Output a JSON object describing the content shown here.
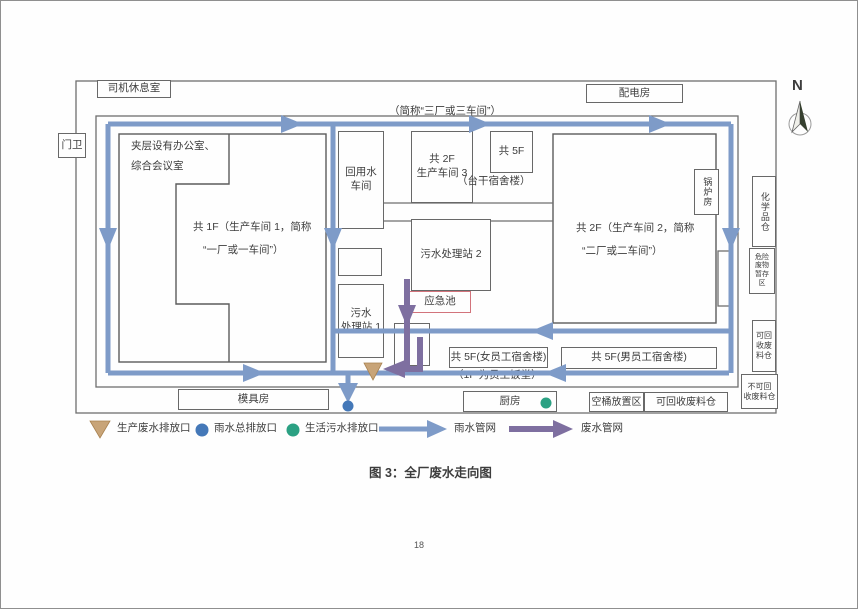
{
  "page": {
    "caption": "图 3：全厂废水走向图",
    "number": "18"
  },
  "compass": {
    "label": "N"
  },
  "colors": {
    "rain_pipe": "#7e9bc8",
    "waste_pipe": "#7e6fa0",
    "prod_marker": "#c8a478",
    "prod_marker_edge": "#a8814f",
    "rain_dot": "#4478b8",
    "domestic_dot": "#2ba183",
    "emergency": "#d2737b"
  },
  "rooms": {
    "driver_rest": "司机休息室",
    "power_dist": "配电房",
    "gate": "门卫",
    "mezzanine_l1": "夹层设有办公室、",
    "mezzanine_l2": "综合会议室",
    "workshop1_l1": "共 1F（生产车间 1，简称",
    "workshop1_l2": "“一厂或一车间”）",
    "alias3": "（简称“三厂或三车间”）",
    "reuse_l1": "回用水",
    "reuse_l2": "车间",
    "workshop3_l1": "共 2F",
    "workshop3_l2": "生产车间 3",
    "taigan_floors": "共 5F",
    "taigan_name": "（台干宿舍楼）",
    "sewage2": "污水处理站 2",
    "emergency": "应急池",
    "sewage1_l1": "污水",
    "sewage1_l2": "处理站 1",
    "workshop2_l1": "共 2F（生产车间 2，简称",
    "workshop2_l2": "“二厂或二车间”）",
    "boiler": "锅炉房",
    "chemical": "化学品仓",
    "hazard": "危险废物暂存区",
    "recycle_right": "可回收废料仓",
    "nonrecycle_l1": "不可回",
    "nonrecycle_l2": "收废料仓",
    "dorm_female": "共 5F(女员工宿舍楼)",
    "dorm_female_note": "（1F 为员工饭堂）",
    "dorm_male": "共 5F(男员工宿舍楼)",
    "mold": "模具房",
    "kitchen": "厨房",
    "bucket_area": "空桶放置区",
    "recycle_bottom": "可回收废料仓"
  },
  "legend": {
    "prod_outfall": "生产废水排放口",
    "rain_outfall": "雨水总排放口",
    "domestic_outfall": "生活污水排放口",
    "rain_pipe": "雨水管网",
    "waste_pipe": "废水管网"
  }
}
